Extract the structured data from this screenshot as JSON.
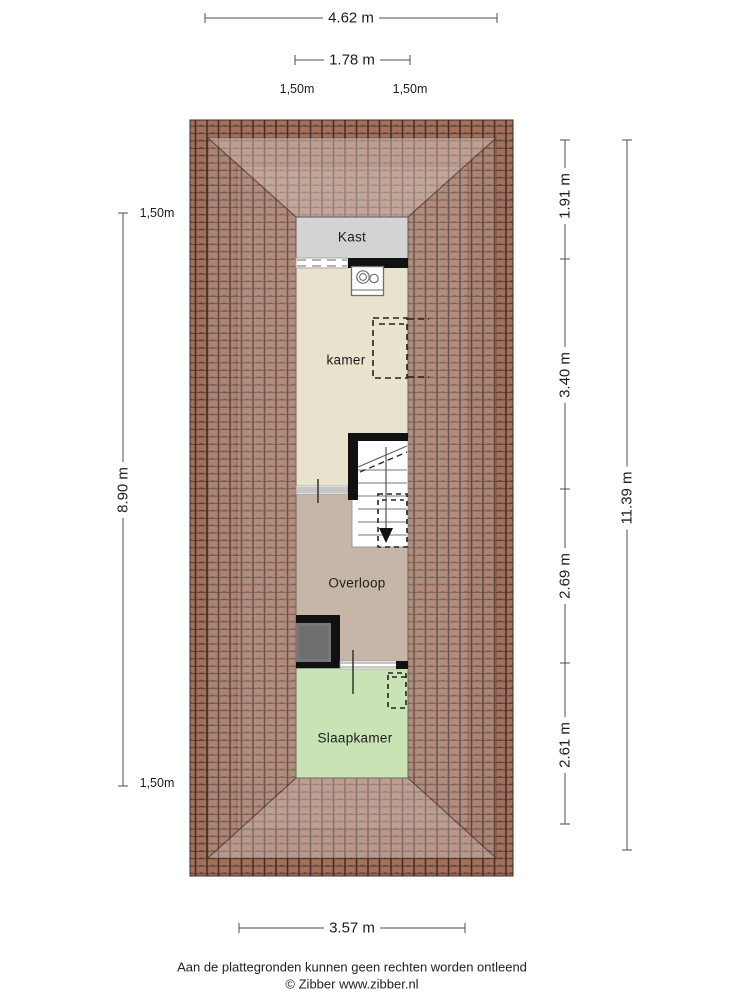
{
  "floorplan": {
    "title": "attic floor plan",
    "rooms": [
      {
        "id": "kast",
        "label": "Kast",
        "color": "#d3d3d5"
      },
      {
        "id": "kamer",
        "label": "kamer",
        "color": "#e9e2cd"
      },
      {
        "id": "overloop",
        "label": "Overloop",
        "color": "#c6b6a8"
      },
      {
        "id": "slaapkamer",
        "label": "Slaapkamer",
        "color": "#c9e3b5"
      }
    ],
    "roof_color": "#996753",
    "roof_line_color": "#3f2f28",
    "wall_color": "#111111",
    "chimney_color": "#77777a"
  },
  "dimensions": {
    "top_total": "4.62 m",
    "top_inner": "1.78 m",
    "contour_top_left": "1,50m",
    "contour_top_right": "1,50m",
    "contour_left_top": "1,50m",
    "left_height": "8.90 m",
    "contour_left_bottom": "1,50m",
    "right_segments": [
      "1.91 m",
      "3.40 m",
      "2.69 m",
      "2.61 m"
    ],
    "right_total": "11.39 m",
    "bottom_width": "3.57 m"
  },
  "footer": {
    "disclaimer": "Aan de plattegronden kunnen geen rechten worden ontleend",
    "copyright": "© Zibber www.zibber.nl"
  }
}
